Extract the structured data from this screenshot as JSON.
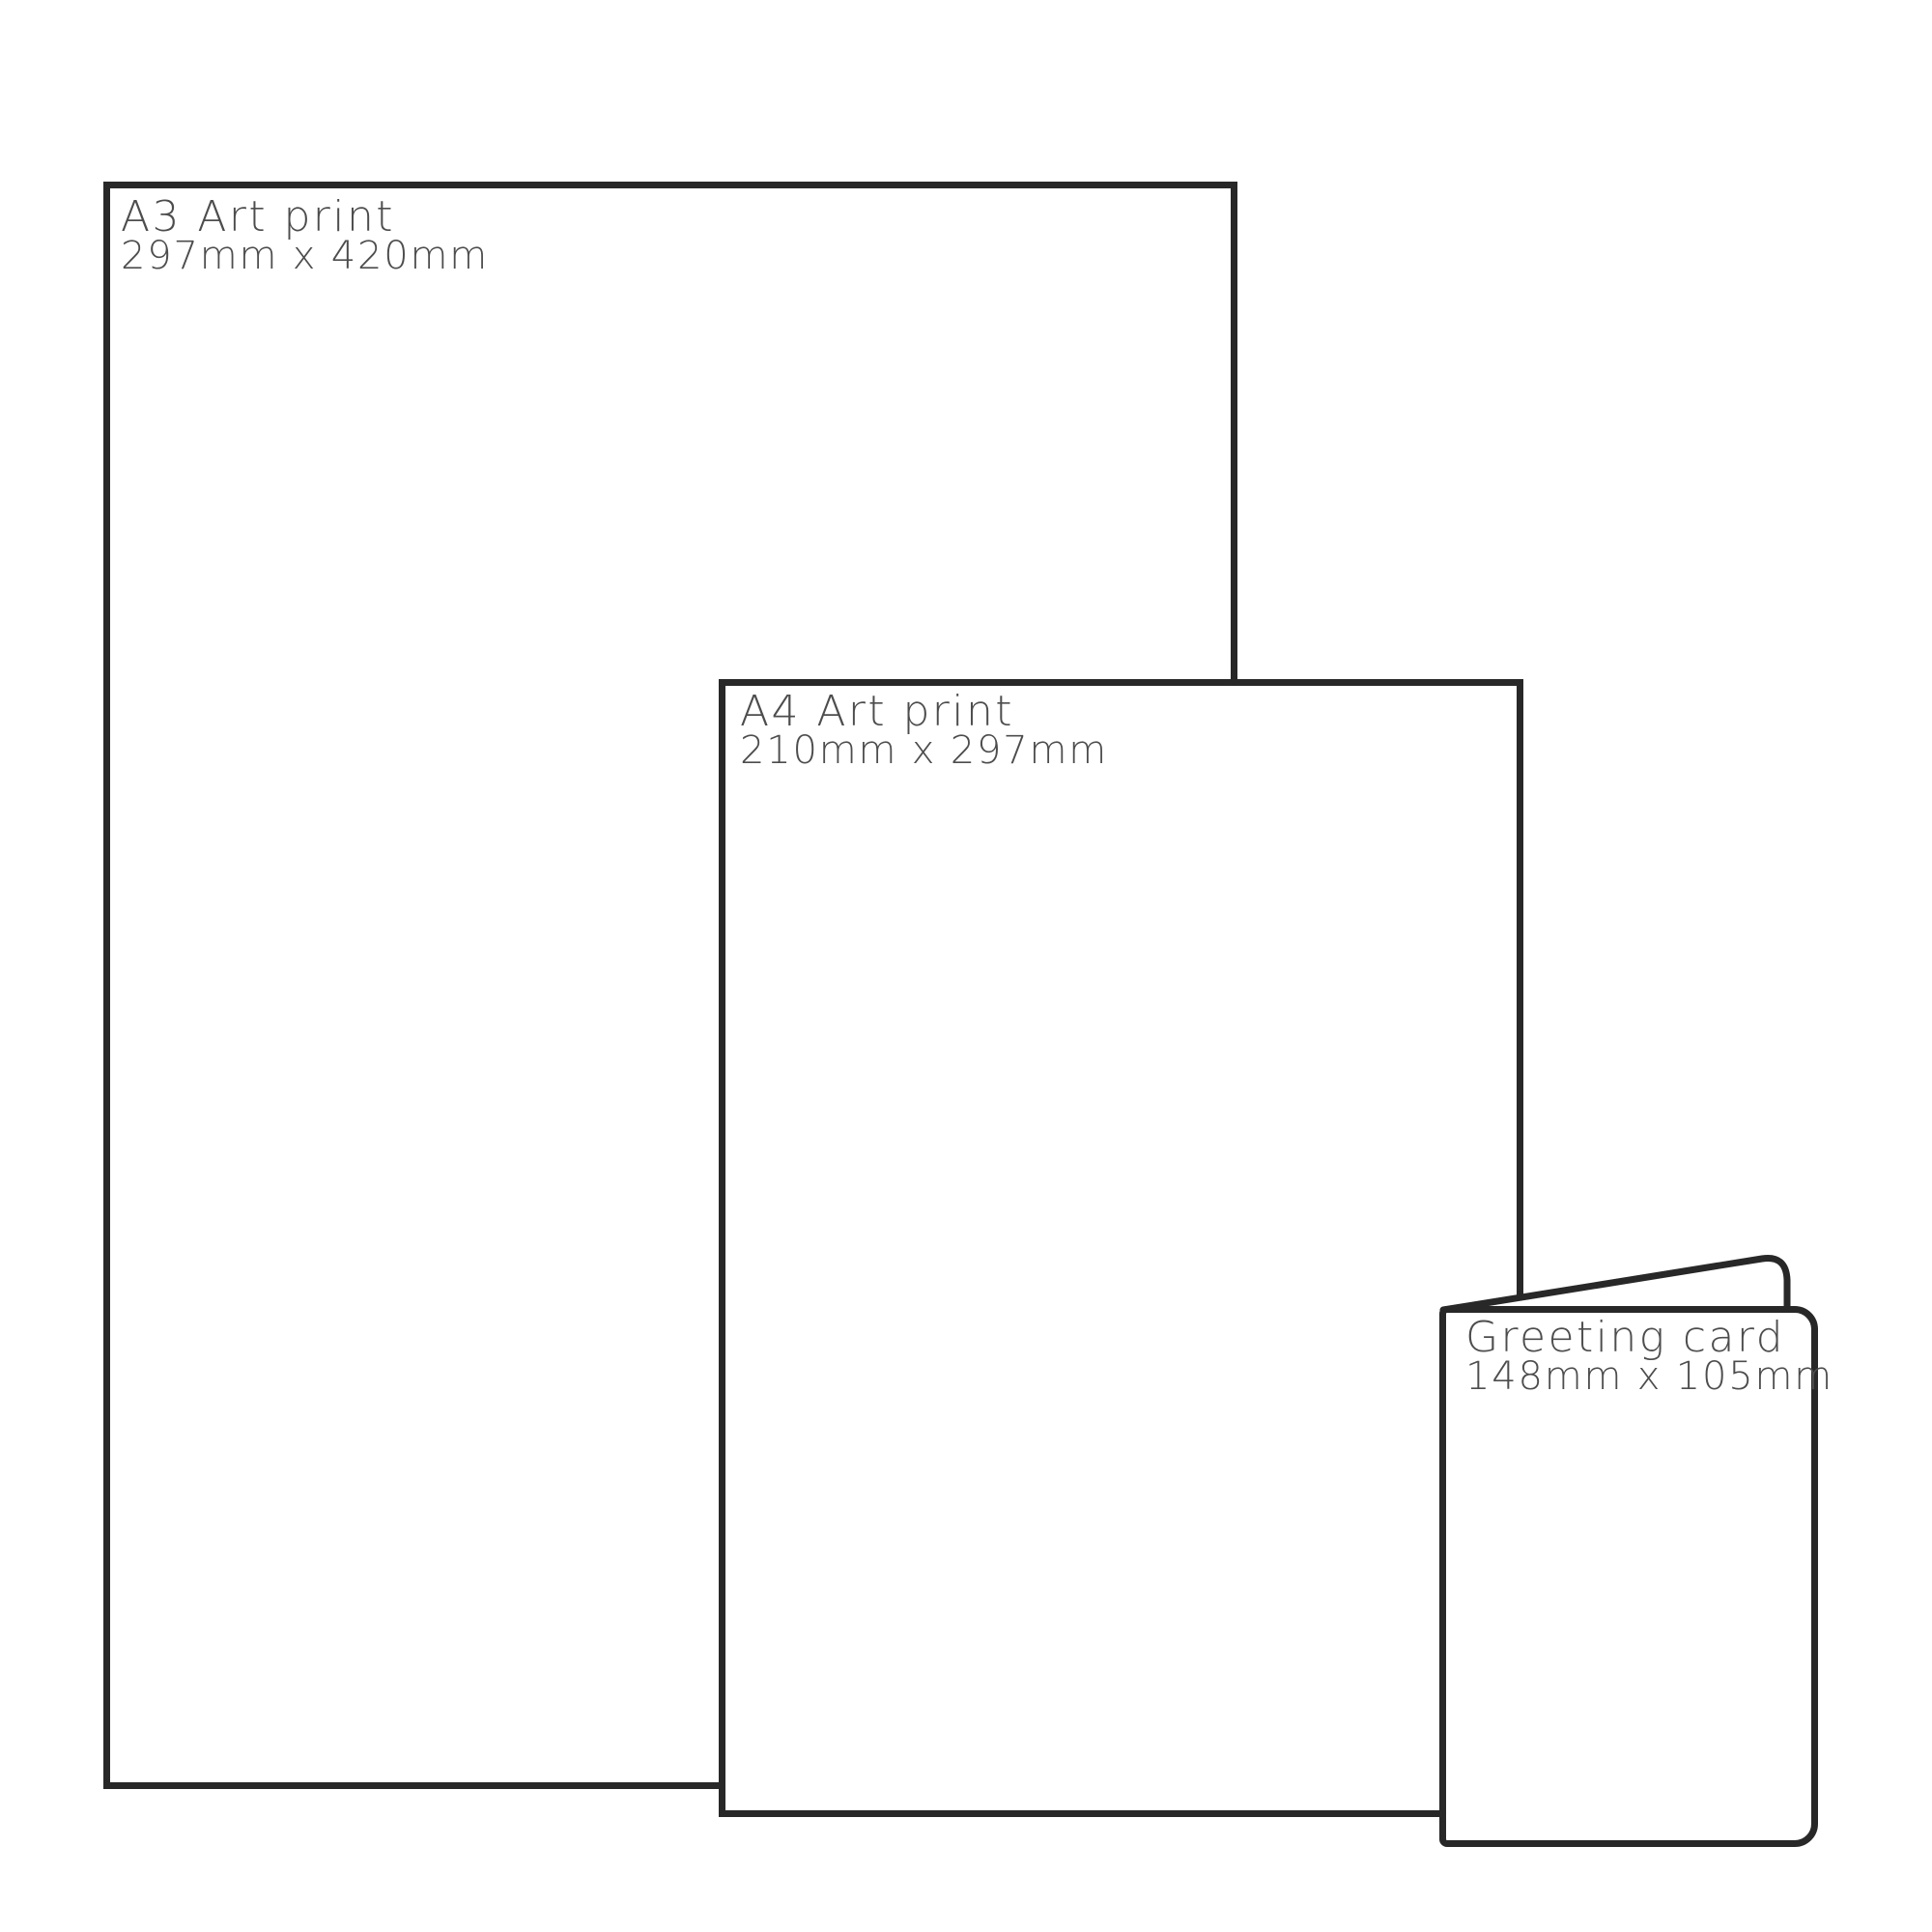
{
  "colors": {
    "background": "#ffffff",
    "outline": "#282828",
    "label_text": "#4d4d4d"
  },
  "items": [
    {
      "id": "a3-art-print",
      "title": "A3 Art print",
      "dimensions": "297mm x 420mm"
    },
    {
      "id": "a4-art-print",
      "title": "A4 Art print",
      "dimensions": "210mm x 297mm"
    },
    {
      "id": "greeting-card",
      "title": "Greeting card",
      "dimensions": "148mm x 105mm"
    }
  ]
}
